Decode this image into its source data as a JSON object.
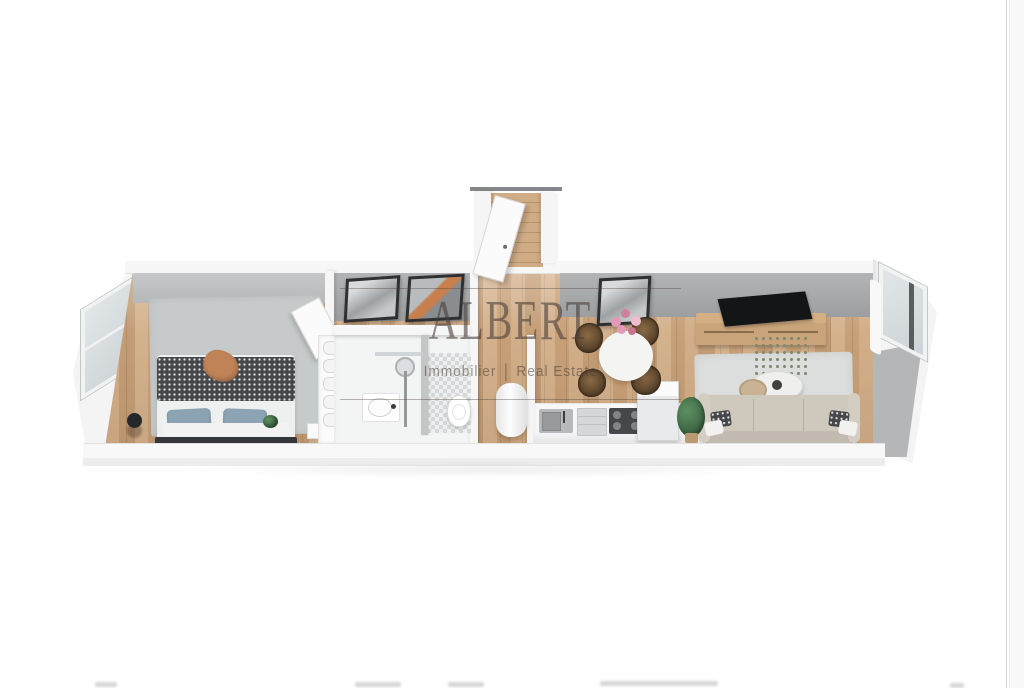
{
  "page": {
    "background_color": "#ffffff",
    "right_edge": {
      "line_color": "#d2d2d3",
      "strip_color": "#f8f8f9"
    }
  },
  "watermark": {
    "brand": "ALBERT",
    "tagline_left": "Immobilier",
    "tagline_divider": "|",
    "tagline_right": "Real Estate",
    "text_color": "rgba(74,64,56,0.60)"
  },
  "scene": {
    "description": "3D isometric render of a long one-bedroom apartment floor plan",
    "rooms": [
      "bedroom",
      "wardrobe",
      "bathroom",
      "entry-hall",
      "kitchen-dining",
      "living-room"
    ]
  },
  "palette": {
    "wood_floor": "#cda57c",
    "interior_wall_face": "#9c9ea0",
    "outer_wall": "#f4f4f5",
    "bedroom_rug": "#c7cacb",
    "living_rug": "#dcdedd",
    "sofa": "#cfc8bd",
    "tv": "#141517",
    "console_wood": "#c9a47a",
    "bed_blanket": "#45474b",
    "pillow_blue": "#8ba3b3",
    "dining_chair": "#523d27",
    "plant_green": "#3a6340",
    "flower_pink": "#e39ab8",
    "accent_throw": "#c08357"
  },
  "footer": {
    "cropped_text_marks": "illegible-text-fragments-cut-by-image-edge"
  }
}
